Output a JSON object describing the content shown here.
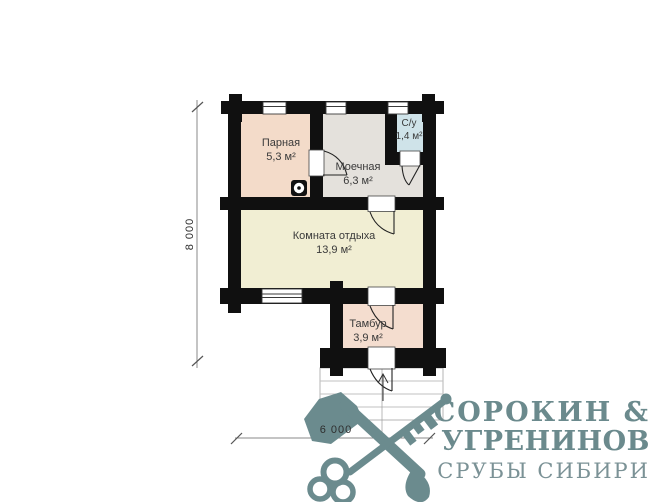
{
  "plan": {
    "rooms": [
      {
        "id": "parnaya",
        "name": "Парная",
        "area": "5,3 м²",
        "fill": "#f3dbc9"
      },
      {
        "id": "moechnaya",
        "name": "Моечная",
        "area": "6,3 м²",
        "fill": "#e4e1dc"
      },
      {
        "id": "su",
        "name": "С/у",
        "area": "1,4 м²",
        "fill": "#cfe3e9"
      },
      {
        "id": "komnata",
        "name": "Комната отдыха",
        "area": "13,9 м²",
        "fill": "#f1eed3"
      },
      {
        "id": "tambur",
        "name": "Тамбур",
        "area": "3,9 м²",
        "fill": "#f4ddcf"
      }
    ],
    "dimensions": {
      "vertical": "8 000",
      "horizontal": "6 000"
    },
    "wall_color": "#101010",
    "dim_color": "#8a8a8a",
    "symbols": {
      "stove": "stove-drain-icon",
      "entrance_arrow": "entry-arrow-icon"
    }
  },
  "logo": {
    "line1": "СОРОКИН &",
    "line2": "УГРЕНИНОВ",
    "line3": "СРУБЫ СИБИРИ",
    "color": "#6b8a8d",
    "light_color": "#7b9296",
    "icon": "crossed-axe-key-icon"
  }
}
